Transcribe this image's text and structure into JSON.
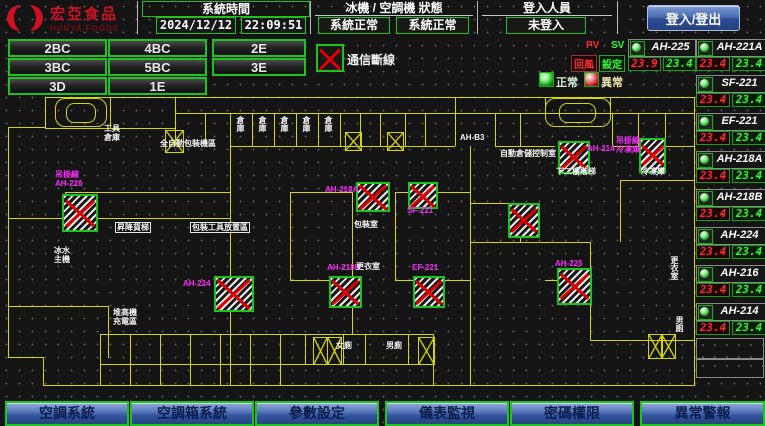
{
  "header": {
    "logo": {
      "title": "宏亞食品",
      "subtitle": "HUNYA FOODS"
    },
    "time": {
      "label": "系統時間",
      "date": "2024/12/12",
      "time": "22:09:51"
    },
    "status": {
      "label": "冰機 / 空調機 狀態",
      "chiller": "系統正常",
      "ahu": "系統正常"
    },
    "login": {
      "label": "登入人員",
      "value": "未登入"
    },
    "login_button": "登入/登出"
  },
  "floor_buttons": [
    "2BC",
    "4BC",
    "2E",
    "3BC",
    "5BC",
    "3E",
    "3D",
    "1E"
  ],
  "legend": {
    "offline": "通信斷線",
    "normal": "正常",
    "abnormal": "異常",
    "pv": "PV",
    "sv": "SV",
    "return_air": "回風",
    "setpoint": "設定"
  },
  "units": [
    {
      "name": "AH-225",
      "pv": "23.9",
      "sv": "23.4"
    },
    {
      "name": "AH-221A",
      "pv": "23.4",
      "sv": "23.4"
    },
    {
      "name": "SF-221",
      "pv": "23.4",
      "sv": "23.4"
    },
    {
      "name": "EF-221",
      "pv": "23.4",
      "sv": "23.4"
    },
    {
      "name": "AH-218A",
      "pv": "23.4",
      "sv": "23.4"
    },
    {
      "name": "AH-218B",
      "pv": "23.4",
      "sv": "23.4"
    },
    {
      "name": "AH-224",
      "pv": "23.4",
      "sv": "23.4"
    },
    {
      "name": "AH-216",
      "pv": "23.4",
      "sv": "23.4"
    },
    {
      "name": "AH-214",
      "pv": "23.4",
      "sv": "23.4"
    }
  ],
  "bottom_nav": [
    "空調系統",
    "空調箱系統",
    "參數設定",
    "儀表監視",
    "密碼權限",
    "異常警報"
  ],
  "colors": {
    "accent_green": "#1ec41e",
    "alarm_red": "#dd0000",
    "magenta_label": "#ff29ff",
    "wall_yellow": "#d6d600",
    "pv_red": "#ff2a2a",
    "sv_green": "#2aff2a",
    "button_blue": "#33549e"
  },
  "floorplan": {
    "offline_boxes": [
      {
        "x": 62,
        "y": 194,
        "w": 32,
        "h": 34
      },
      {
        "x": 214,
        "y": 276,
        "w": 36,
        "h": 32
      },
      {
        "x": 356,
        "y": 182,
        "w": 30,
        "h": 26
      },
      {
        "x": 408,
        "y": 182,
        "w": 26,
        "h": 23
      },
      {
        "x": 508,
        "y": 203,
        "w": 28,
        "h": 31
      },
      {
        "x": 329,
        "y": 276,
        "w": 29,
        "h": 28
      },
      {
        "x": 413,
        "y": 276,
        "w": 28,
        "h": 28
      },
      {
        "x": 558,
        "y": 141,
        "w": 28,
        "h": 29
      },
      {
        "x": 639,
        "y": 138,
        "w": 23,
        "h": 31
      },
      {
        "x": 557,
        "y": 268,
        "w": 31,
        "h": 33
      }
    ],
    "magenta_labels": [
      {
        "x": 55,
        "y": 170,
        "t": "吊掛線\nAH-226"
      },
      {
        "x": 183,
        "y": 279,
        "t": "AH-224"
      },
      {
        "x": 325,
        "y": 185,
        "t": "AH-218A"
      },
      {
        "x": 407,
        "y": 206,
        "t": "SF-221"
      },
      {
        "x": 327,
        "y": 263,
        "t": "AH-218B"
      },
      {
        "x": 412,
        "y": 263,
        "t": "EF-221"
      },
      {
        "x": 587,
        "y": 144,
        "t": "AH-214"
      },
      {
        "x": 616,
        "y": 136,
        "t": "吊掛線\n冷凍庫"
      },
      {
        "x": 555,
        "y": 259,
        "t": "AH-225"
      }
    ],
    "white_labels": [
      {
        "x": 104,
        "y": 124,
        "t": "工具\n倉庫"
      },
      {
        "x": 160,
        "y": 139,
        "t": "全自動包裝機區"
      },
      {
        "x": 236,
        "y": 116,
        "t": "倉庫",
        "v": 1
      },
      {
        "x": 258,
        "y": 116,
        "t": "倉庫",
        "v": 1
      },
      {
        "x": 280,
        "y": 116,
        "t": "倉庫",
        "v": 1
      },
      {
        "x": 302,
        "y": 116,
        "t": "倉庫",
        "v": 1
      },
      {
        "x": 324,
        "y": 116,
        "t": "倉庫",
        "v": 1
      },
      {
        "x": 460,
        "y": 133,
        "t": "AH-B3"
      },
      {
        "x": 500,
        "y": 149,
        "t": "自動倉儲控制室"
      },
      {
        "x": 556,
        "y": 167,
        "t": "下二樓階梯"
      },
      {
        "x": 641,
        "y": 167,
        "t": "冷凍庫"
      },
      {
        "x": 354,
        "y": 220,
        "t": "包裝室"
      },
      {
        "x": 356,
        "y": 262,
        "t": "更衣室"
      },
      {
        "x": 670,
        "y": 256,
        "t": "更衣室",
        "v": 1
      },
      {
        "x": 675,
        "y": 316,
        "t": "男廁",
        "v": 1
      },
      {
        "x": 336,
        "y": 341,
        "t": "女廁"
      },
      {
        "x": 386,
        "y": 341,
        "t": "男廁"
      },
      {
        "x": 115,
        "y": 222,
        "t": "昇降貨梯",
        "box": 1
      },
      {
        "x": 190,
        "y": 222,
        "t": "包裝工具放置區",
        "box": 1
      },
      {
        "x": 54,
        "y": 246,
        "t": "冰水\n主機"
      },
      {
        "x": 113,
        "y": 308,
        "t": "堆高機\n充電區"
      }
    ]
  }
}
